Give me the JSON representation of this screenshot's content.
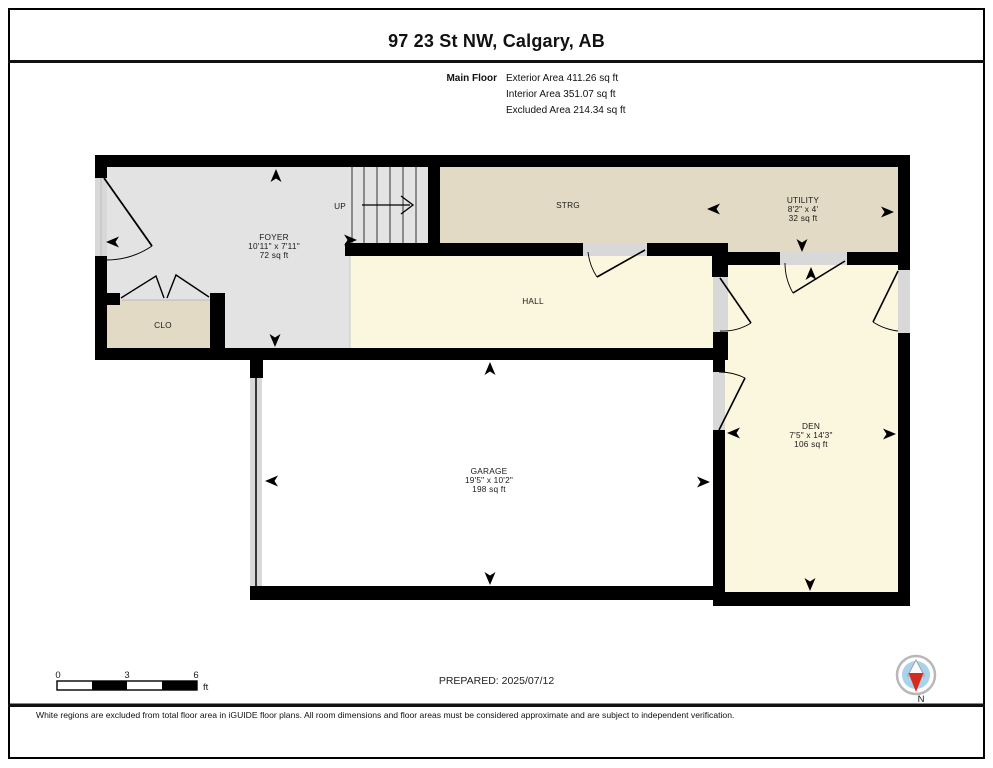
{
  "page": {
    "title": "97 23 St NW, Calgary, AB",
    "floor": {
      "label": "Main Floor",
      "exterior_area": "Exterior Area 411.26 sq ft",
      "interior_area": "Interior Area 351.07 sq ft",
      "excluded_area": "Excluded Area 214.34 sq ft"
    }
  },
  "rooms": {
    "foyer": {
      "name": "FOYER",
      "dims": "10'11\" x 7'11\"",
      "area": "72 sq ft"
    },
    "clo": {
      "name": "CLO"
    },
    "strg": {
      "name": "STRG"
    },
    "utility": {
      "name": "UTILITY",
      "dims": "8'2\" x 4'",
      "area": "32 sq ft"
    },
    "hall": {
      "name": "HALL"
    },
    "garage": {
      "name": "GARAGE",
      "dims": "19'5\" x 10'2\"",
      "area": "198 sq ft"
    },
    "den": {
      "name": "DEN",
      "dims": "7'5\" x 14'3\"",
      "area": "106 sq ft"
    },
    "stairs": {
      "label": "UP"
    }
  },
  "footer": {
    "scale": {
      "tick0": "0",
      "tick1": "3",
      "tick2": "6",
      "unit": "ft"
    },
    "prepared": "PREPARED: 2025/07/12",
    "compass": {
      "label": "N"
    },
    "disclaimer": "White regions are excluded from total floor area in iGUIDE floor plans. All room dimensions and floor areas must be considered approximate and are subject to independent verification."
  },
  "colors": {
    "wall": "#000000",
    "foyer_gray": "#e3e3e3",
    "closet_tan": "#e3dac6",
    "hall_yellow": "#fbf6de",
    "excluded_white": "#ffffff",
    "door_opening": "#d8d8d8",
    "compass_blue": "#a9d3ea",
    "compass_red": "#d42b1e"
  }
}
